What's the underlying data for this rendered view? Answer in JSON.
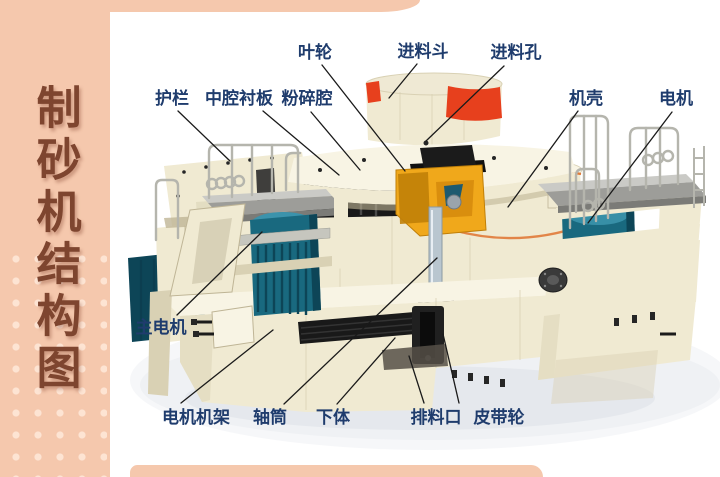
{
  "sidebar": {
    "title_vertical": "制砂机结构图"
  },
  "palette": {
    "sidebar_bg": "#f5c8ad",
    "sidebar_dot": "#fde4d3",
    "title_color": "#7e452f",
    "label_color": "#1f3c6d",
    "leader_line": "#1a1a1a",
    "machine_cream": "#f0ead2",
    "machine_cream_light": "#f8f4e4",
    "machine_cream_dark": "#d9d1b4",
    "machine_cream_shade": "#bfb596",
    "hopper_red": "#e7401d",
    "trim_orange": "#e07a38",
    "motor_teal": "#19697f",
    "motor_teal_dark": "#0d4557",
    "motor_teal_light": "#3b93ac",
    "impeller_yellow": "#f0a81b",
    "impeller_yellow_dark": "#c07f08",
    "metal_black": "#191919",
    "deck_gray": "#9d9d99",
    "deck_gray_light": "#cacac6",
    "rail_gray": "#b5b5ad",
    "shaft_gray": "#b9c6cf",
    "shadow_gray": "#e9edf1"
  },
  "diagram": {
    "machine_name": "制砂机",
    "labels": [
      {
        "id": "impeller",
        "text": "叶轮",
        "tx": 315,
        "ty": 58,
        "line": {
          "x1": 322,
          "y1": 65,
          "x2": 405,
          "y2": 171
        }
      },
      {
        "id": "feed-hopper",
        "text": "进料斗",
        "tx": 423,
        "ty": 57,
        "line": {
          "x1": 417,
          "y1": 64,
          "x2": 389,
          "y2": 98
        }
      },
      {
        "id": "feed-hole",
        "text": "进料孔",
        "tx": 516,
        "ty": 58,
        "line": {
          "x1": 504,
          "y1": 66,
          "x2": 426,
          "y2": 141
        }
      },
      {
        "id": "guardrail",
        "text": "护栏",
        "tx": 172,
        "ty": 104,
        "line": {
          "x1": 178,
          "y1": 111,
          "x2": 230,
          "y2": 161
        }
      },
      {
        "id": "middle-cavity-liner",
        "text": "中腔衬板",
        "tx": 239,
        "ty": 104,
        "line": {
          "x1": 263,
          "y1": 111,
          "x2": 339,
          "y2": 175
        }
      },
      {
        "id": "crushing-chamber",
        "text": "粉碎腔",
        "tx": 307,
        "ty": 104,
        "line": {
          "x1": 311,
          "y1": 112,
          "x2": 360,
          "y2": 170
        }
      },
      {
        "id": "casing",
        "text": "机壳",
        "tx": 586,
        "ty": 104,
        "line": {
          "x1": 578,
          "y1": 111,
          "x2": 508,
          "y2": 207
        }
      },
      {
        "id": "motor",
        "text": "电机",
        "tx": 676,
        "ty": 104,
        "line": {
          "x1": 672,
          "y1": 112,
          "x2": 588,
          "y2": 223
        }
      },
      {
        "id": "main-motor",
        "text": "主电机",
        "tx": 161,
        "ty": 333,
        "line": {
          "x1": 177,
          "y1": 315,
          "x2": 262,
          "y2": 232
        }
      },
      {
        "id": "motor-frame",
        "text": "电机机架",
        "tx": 196,
        "ty": 423,
        "line": {
          "x1": 181,
          "y1": 403,
          "x2": 273,
          "y2": 330
        }
      },
      {
        "id": "shaft-tube",
        "text": "轴筒",
        "tx": 270,
        "ty": 423,
        "line": {
          "x1": 284,
          "y1": 404,
          "x2": 437,
          "y2": 258
        }
      },
      {
        "id": "lower-body",
        "text": "下体",
        "tx": 333,
        "ty": 423,
        "line": {
          "x1": 337,
          "y1": 404,
          "x2": 395,
          "y2": 338
        }
      },
      {
        "id": "discharge-port",
        "text": "排料口",
        "tx": 436,
        "ty": 423,
        "line": {
          "x1": 424,
          "y1": 403,
          "x2": 409,
          "y2": 356
        }
      },
      {
        "id": "belt-pulley",
        "text": "皮带轮",
        "tx": 499,
        "ty": 423,
        "line": {
          "x1": 459,
          "y1": 403,
          "x2": 443,
          "y2": 334
        }
      }
    ]
  }
}
